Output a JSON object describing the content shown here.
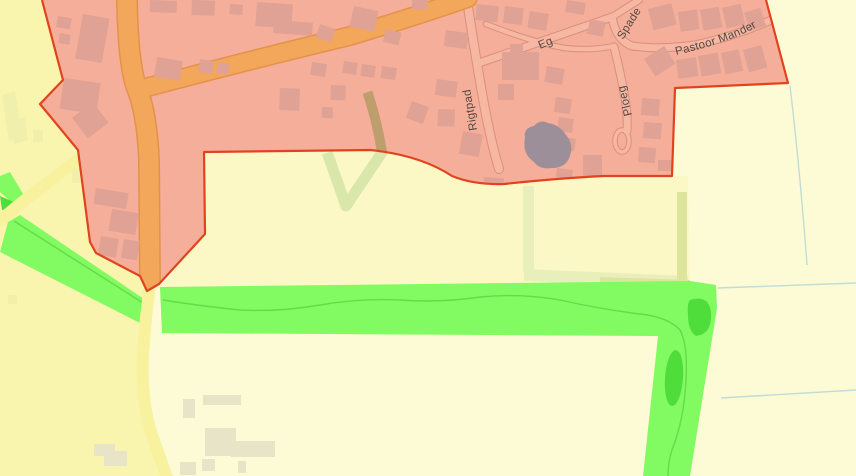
{
  "labels": {
    "rigtpad": "Rigtpad",
    "eg": "Eg",
    "spade": "Spade",
    "ploeg": "Ploeg",
    "pastoor_mander": "Pastoor Mander"
  },
  "palette": {
    "field_base": "#fcfbd6",
    "field_left": "#faf5ae",
    "field_mid": "#fbf8c6",
    "patch": "#f1efac",
    "zone_fill": "#f5ae9a",
    "zone_stroke": "#e2431f",
    "building": "#dfa294",
    "building_outside": "#e7e4c8",
    "road_orange": "#f2a75b",
    "road_orange_edge": "#e4924a",
    "road_yellow": "#f8f19d",
    "street_fill": "#f6b7a3",
    "street_edge": "#da8f7d",
    "green": "#82fa61",
    "green_dark": "#4fdd3b",
    "stream": "#63dc4a",
    "hedge": "#e9efbb",
    "khaki": "#dde59d",
    "pond": "#9c8f99",
    "ditch": "#c2ddd5",
    "track_green": "#d9e7ab",
    "track_brown": "#bf9e6d",
    "label": "#46403c"
  }
}
